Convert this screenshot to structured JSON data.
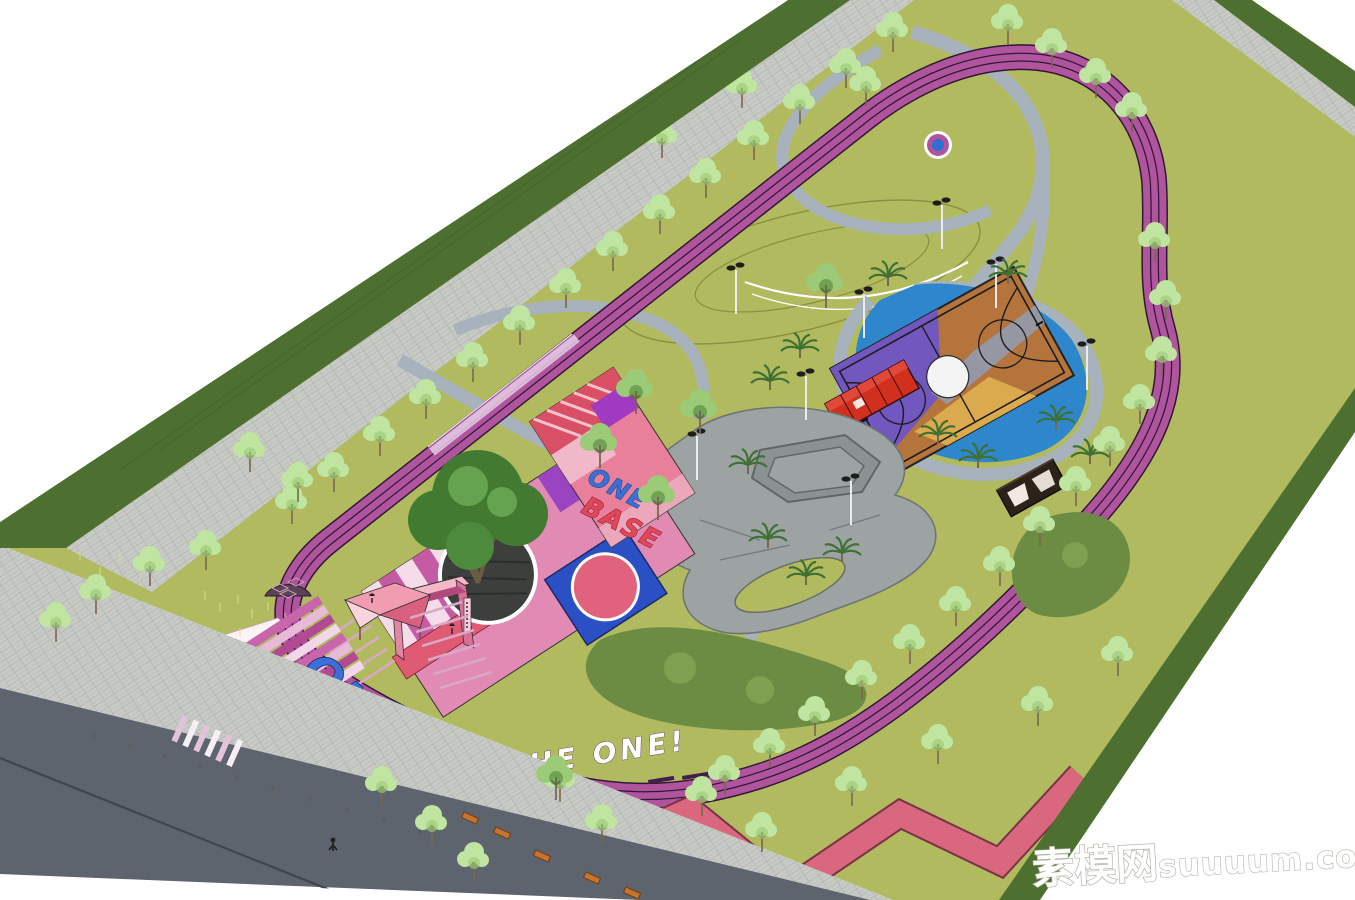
{
  "scene": {
    "description": "Aerial 3D render of a pink-and-magenta themed sports park with running track, skate park, basketball court and entrance plaza"
  },
  "texts": {
    "plaza_line1": "ONE",
    "plaza_line2": "BASE",
    "entrance_primary": "ONE",
    "entrance_secondary": "BASE",
    "track_slogan": "THE ONE!",
    "watermark_cn": "素模网",
    "watermark_latin": "suuuum.com"
  },
  "colors": {
    "lawn": "#b1ba5e",
    "lawnlight": "#bcc56c",
    "hedge": "#4d7031",
    "paving": "#c7cac5",
    "pavingline": "#b2b5af",
    "road": "#5d646e",
    "roadline": "#3f454e",
    "track": "#b0549e",
    "trackline": "#2e1835",
    "trackpale": "#e6cfe6",
    "walkway": "#a8b2bd",
    "concrete": "#9ca3a2",
    "concreteedge": "#6e7576",
    "pond": "#2e86cc",
    "courtpurple": "#7257be",
    "courtorange": "#b5743c",
    "courtyellow": "#dba94e",
    "courtgray": "#9598a2",
    "courtline": "#1c1c1c",
    "containerred": "#d2301f",
    "containerdark": "#2c221a",
    "bush": "#6d8c43",
    "treelight": "#bfe5a1",
    "treemid": "#9ccb77",
    "treedark": "#437a31",
    "trunk": "#77674f",
    "palm": "#3f7134",
    "plazapink": "#e08ab4",
    "plazapale": "#f6dce9",
    "plazamagenta": "#c45ba4",
    "plazared": "#df5b73",
    "plazapurple": "#9a44c2",
    "bluesquare": "#2b50c4",
    "circlered": "#e0627c",
    "salmon": "#d9677e",
    "textblue": "#3b6fd8",
    "textred": "#e04858",
    "white": "#ffffff",
    "watermarkstroke": "#b4b4a6"
  }
}
